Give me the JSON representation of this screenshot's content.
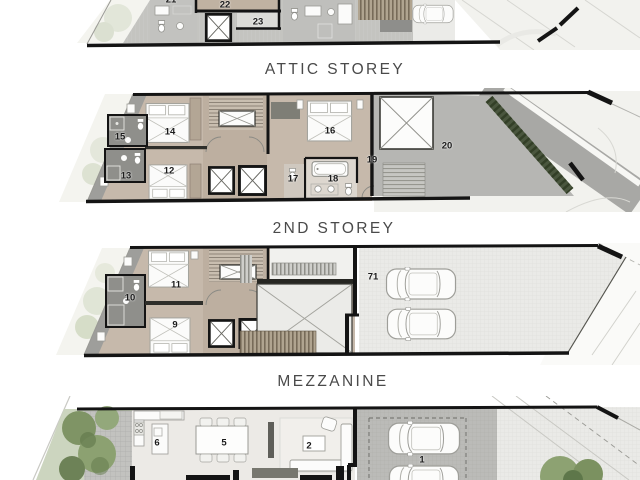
{
  "document": {
    "storey_labels": [
      {
        "label": "ATTIC STOREY"
      },
      {
        "label": "2ND STOREY"
      },
      {
        "label": "MEZZANINE"
      }
    ],
    "plans": {
      "attic": {
        "rooms": [
          {
            "number": "21"
          },
          {
            "number": "22"
          },
          {
            "number": "23"
          }
        ]
      },
      "second": {
        "rooms": [
          {
            "number": "15"
          },
          {
            "number": "14"
          },
          {
            "number": "13"
          },
          {
            "number": "12"
          },
          {
            "number": "16"
          },
          {
            "number": "17"
          },
          {
            "number": "18"
          },
          {
            "number": "19"
          },
          {
            "number": "20"
          }
        ]
      },
      "mezzanine": {
        "rooms": [
          {
            "number": "10"
          },
          {
            "number": "11"
          },
          {
            "number": "9"
          },
          {
            "number": "71"
          }
        ]
      },
      "first": {
        "rooms": [
          {
            "number": "6"
          },
          {
            "number": "5"
          },
          {
            "number": "2"
          },
          {
            "number": "1"
          }
        ]
      }
    },
    "colors": {
      "wall": "#141414",
      "bedroom_floor": "#c6b9ab",
      "bathroom_tile": "#8f8f8b",
      "roof_gray": "#c7c7c4",
      "terrace_gray": "#b6b6b3",
      "parking_light": "#eaeae7",
      "garage_gray": "#bbbbb8",
      "site_light": "#f2f2ee",
      "hedge_green": "#4a563e",
      "tree_green": "#7f9465",
      "label_text": "#4a4a4a",
      "number_text": "#1b1b1b"
    }
  }
}
